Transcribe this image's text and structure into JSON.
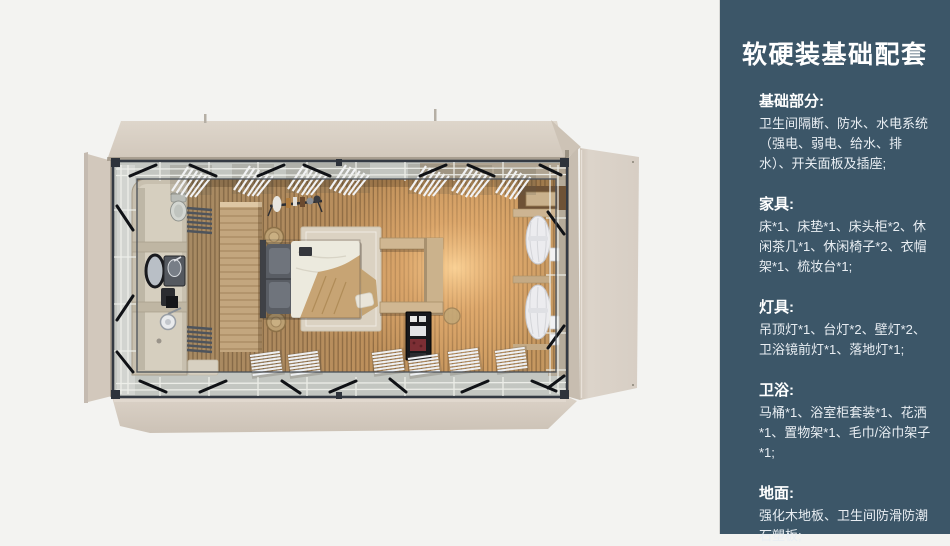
{
  "page": {
    "background": "#f3f3f1"
  },
  "sidebar": {
    "bg": "#3c5668",
    "heading_color": "#ffffff",
    "body_color": "#e9eef3",
    "title": "软硬装基础配套",
    "sections": [
      {
        "heading": "基础部分:",
        "body": "卫生间隔断、防水、水电系统（强电、弱电、给水、排水）、开关面板及插座;"
      },
      {
        "heading": "家具:",
        "body": "床*1、床垫*1、床头柜*2、休闲茶几*1、休闲椅子*2、衣帽架*1、梳妆台*1;"
      },
      {
        "heading": "灯具:",
        "body": "吊顶灯*1、台灯*2、壁灯*2、卫浴镜前灯*1、落地灯*1;"
      },
      {
        "heading": "卫浴:",
        "body": "马桶*1、浴室柜套装*1、花洒*1、置物架*1、毛巾/浴巾架子*1;"
      },
      {
        "heading": "地面:",
        "body": "强化木地板、卫生间防滑防潮石塑板;"
      }
    ]
  },
  "scene": {
    "type": "top-down 3D render",
    "subject": "prefab container guest room with bathroom pod, bed, wardrobe partition and lounge corner",
    "colors": {
      "shell_beige": "#d6ccc1",
      "steel_frame": "#343a43",
      "glass_band": "#c3c6c1",
      "floor_wood": "#c1925c",
      "floor_glow": "#ffd79b",
      "bathroom_stone": "#d6cfbf",
      "bedding_white": "#eceade",
      "blanket_tan": "#c7a474",
      "pillow_gray": "#595d64",
      "curtain_white": "#ececef"
    },
    "items": [
      "bathroom-pod",
      "toilet",
      "vanity-mirror",
      "shower",
      "towel-racks",
      "partition-wardrobe",
      "coat-rack",
      "bed",
      "rug",
      "nightstand-baskets",
      "wall-shelf",
      "minibar-cabinet",
      "lounge-curtains",
      "ceiling-slats",
      "steel-frame",
      "shell-flaps"
    ]
  }
}
